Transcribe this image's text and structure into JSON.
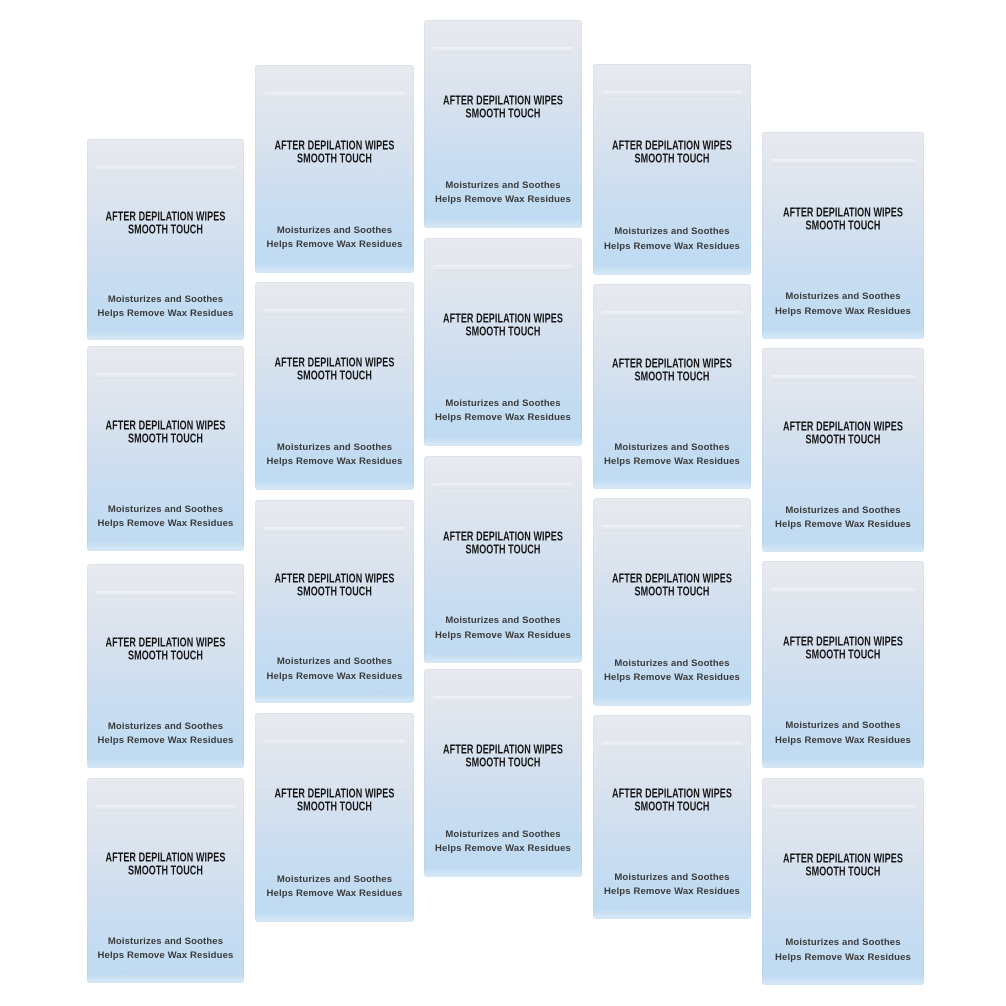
{
  "packet": {
    "title_line1": "AFTER DEPILATION WIPES",
    "title_line2": "SMOOTH TOUCH",
    "subtitle_line1": "Moisturizes and Soothes",
    "subtitle_line2": "Helps Remove Wax Residues"
  },
  "product": {
    "packet_count": 20,
    "arrangement": "5 columns x 4 rows, staggered"
  },
  "colors": {
    "background": "#ffffff",
    "packet_gradient_top": "#e7eaef",
    "packet_gradient_bottom": "#bedaf2",
    "title_text": "#151515",
    "subtitle_text": "#3a3a3a"
  },
  "layout_hints": {
    "columns": 5,
    "rows": 4,
    "packets": [
      {
        "x": 87,
        "y": 139,
        "w": 157,
        "h": 201
      },
      {
        "x": 87,
        "y": 346,
        "w": 157,
        "h": 205
      },
      {
        "x": 87,
        "y": 564,
        "w": 157,
        "h": 204
      },
      {
        "x": 87,
        "y": 778,
        "w": 157,
        "h": 205
      },
      {
        "x": 255,
        "y": 65,
        "w": 159,
        "h": 208
      },
      {
        "x": 255,
        "y": 282,
        "w": 159,
        "h": 208
      },
      {
        "x": 255,
        "y": 500,
        "w": 159,
        "h": 203
      },
      {
        "x": 255,
        "y": 713,
        "w": 159,
        "h": 209
      },
      {
        "x": 424,
        "y": 20,
        "w": 158,
        "h": 208
      },
      {
        "x": 424,
        "y": 238,
        "w": 158,
        "h": 208
      },
      {
        "x": 424,
        "y": 456,
        "w": 158,
        "h": 207
      },
      {
        "x": 424,
        "y": 669,
        "w": 158,
        "h": 208
      },
      {
        "x": 593,
        "y": 64,
        "w": 158,
        "h": 211
      },
      {
        "x": 593,
        "y": 284,
        "w": 158,
        "h": 205
      },
      {
        "x": 593,
        "y": 498,
        "w": 158,
        "h": 208
      },
      {
        "x": 593,
        "y": 715,
        "w": 158,
        "h": 204
      },
      {
        "x": 762,
        "y": 132,
        "w": 162,
        "h": 207
      },
      {
        "x": 762,
        "y": 348,
        "w": 162,
        "h": 204
      },
      {
        "x": 762,
        "y": 561,
        "w": 162,
        "h": 207
      },
      {
        "x": 762,
        "y": 778,
        "w": 162,
        "h": 207
      }
    ]
  }
}
